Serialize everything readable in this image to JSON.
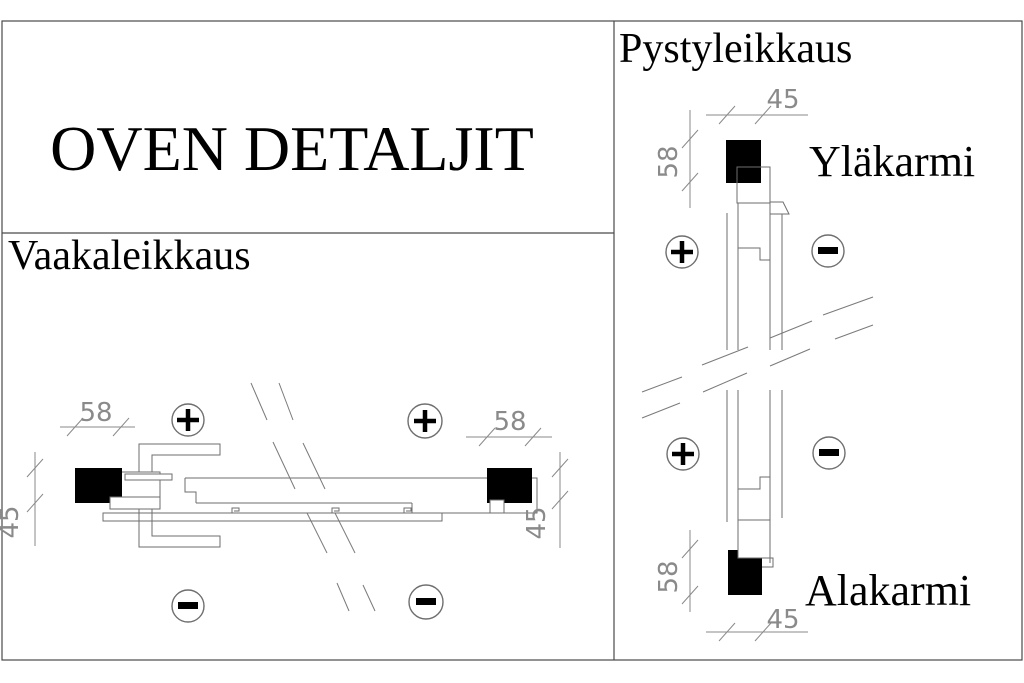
{
  "drawing": {
    "title": "OVEN DETALJIT",
    "sections": {
      "horizontal": {
        "label": "Vaakaleikkaus",
        "dims": {
          "left_width": "58",
          "left_depth": "45",
          "right_width": "58",
          "right_depth": "45"
        }
      },
      "vertical": {
        "label": "Pystyleikkaus",
        "top_frame_label": "Yläkarmi",
        "bottom_frame_label": "Alakarmi",
        "dims": {
          "top_width": "45",
          "top_height": "58",
          "bottom_height": "58",
          "bottom_width": "45"
        }
      }
    },
    "symbols": {
      "plus": "+",
      "minus": "−"
    },
    "icons": {
      "plus_marker": "circled-plus side marker",
      "minus_marker": "circled-minus side marker",
      "break_line": "double diagonal section break lines",
      "frame_section": "solid black wood frame cross-section"
    },
    "colors": {
      "background": "#ffffff",
      "border": "#4a4a4a",
      "line": "#6e6e6e",
      "dimension": "#8a8a8a",
      "text": "#000000",
      "frame_fill": "#000000"
    }
  }
}
